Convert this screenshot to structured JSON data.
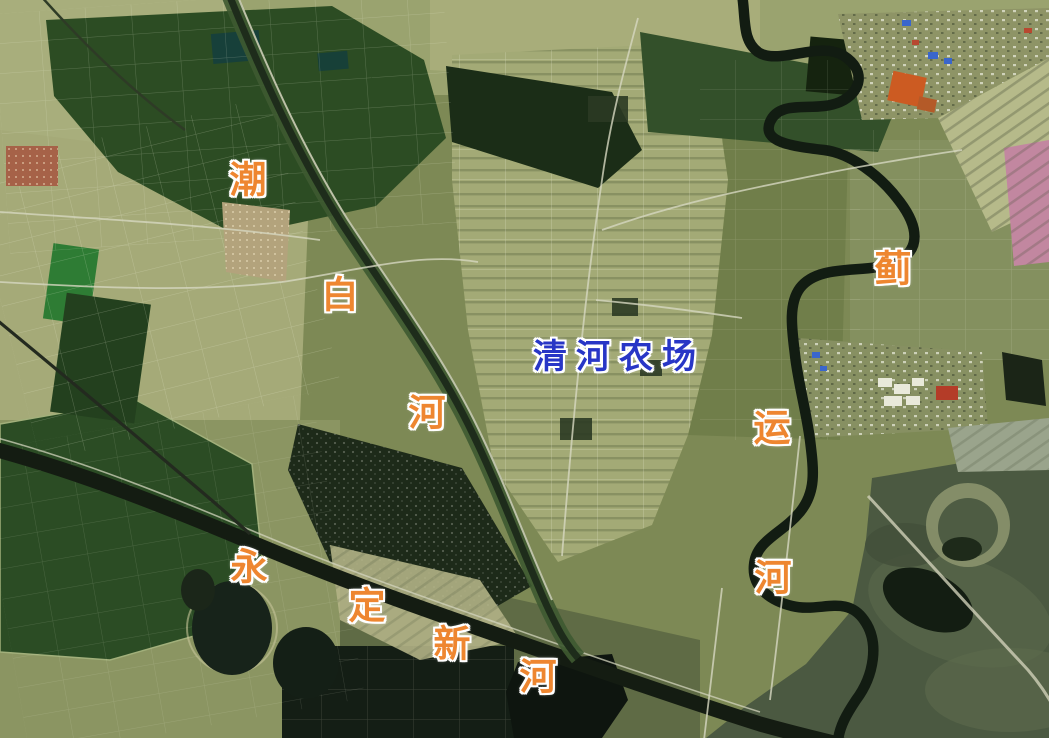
{
  "labels": {
    "farm": {
      "text": "清河农场"
    },
    "river_chars": [
      {
        "text": "潮"
      },
      {
        "text": "白"
      },
      {
        "text": "河"
      },
      {
        "text": "蓟"
      },
      {
        "text": "运"
      },
      {
        "text": "河"
      },
      {
        "text": "永"
      },
      {
        "text": "定"
      },
      {
        "text": "新"
      },
      {
        "text": "河"
      }
    ]
  },
  "colors": {
    "river_label_orange": "#ee8630",
    "farm_label_blue": "#2836c6",
    "label_halo": "#ffffff",
    "field_olive_base": "#7d8955",
    "field_pale": "#a3aa76",
    "field_dark_green": "#2b4c24",
    "water_river_dark": "#121c12",
    "bay_murky_green": "#4b5941",
    "road_pale": "#d3d4bd"
  }
}
